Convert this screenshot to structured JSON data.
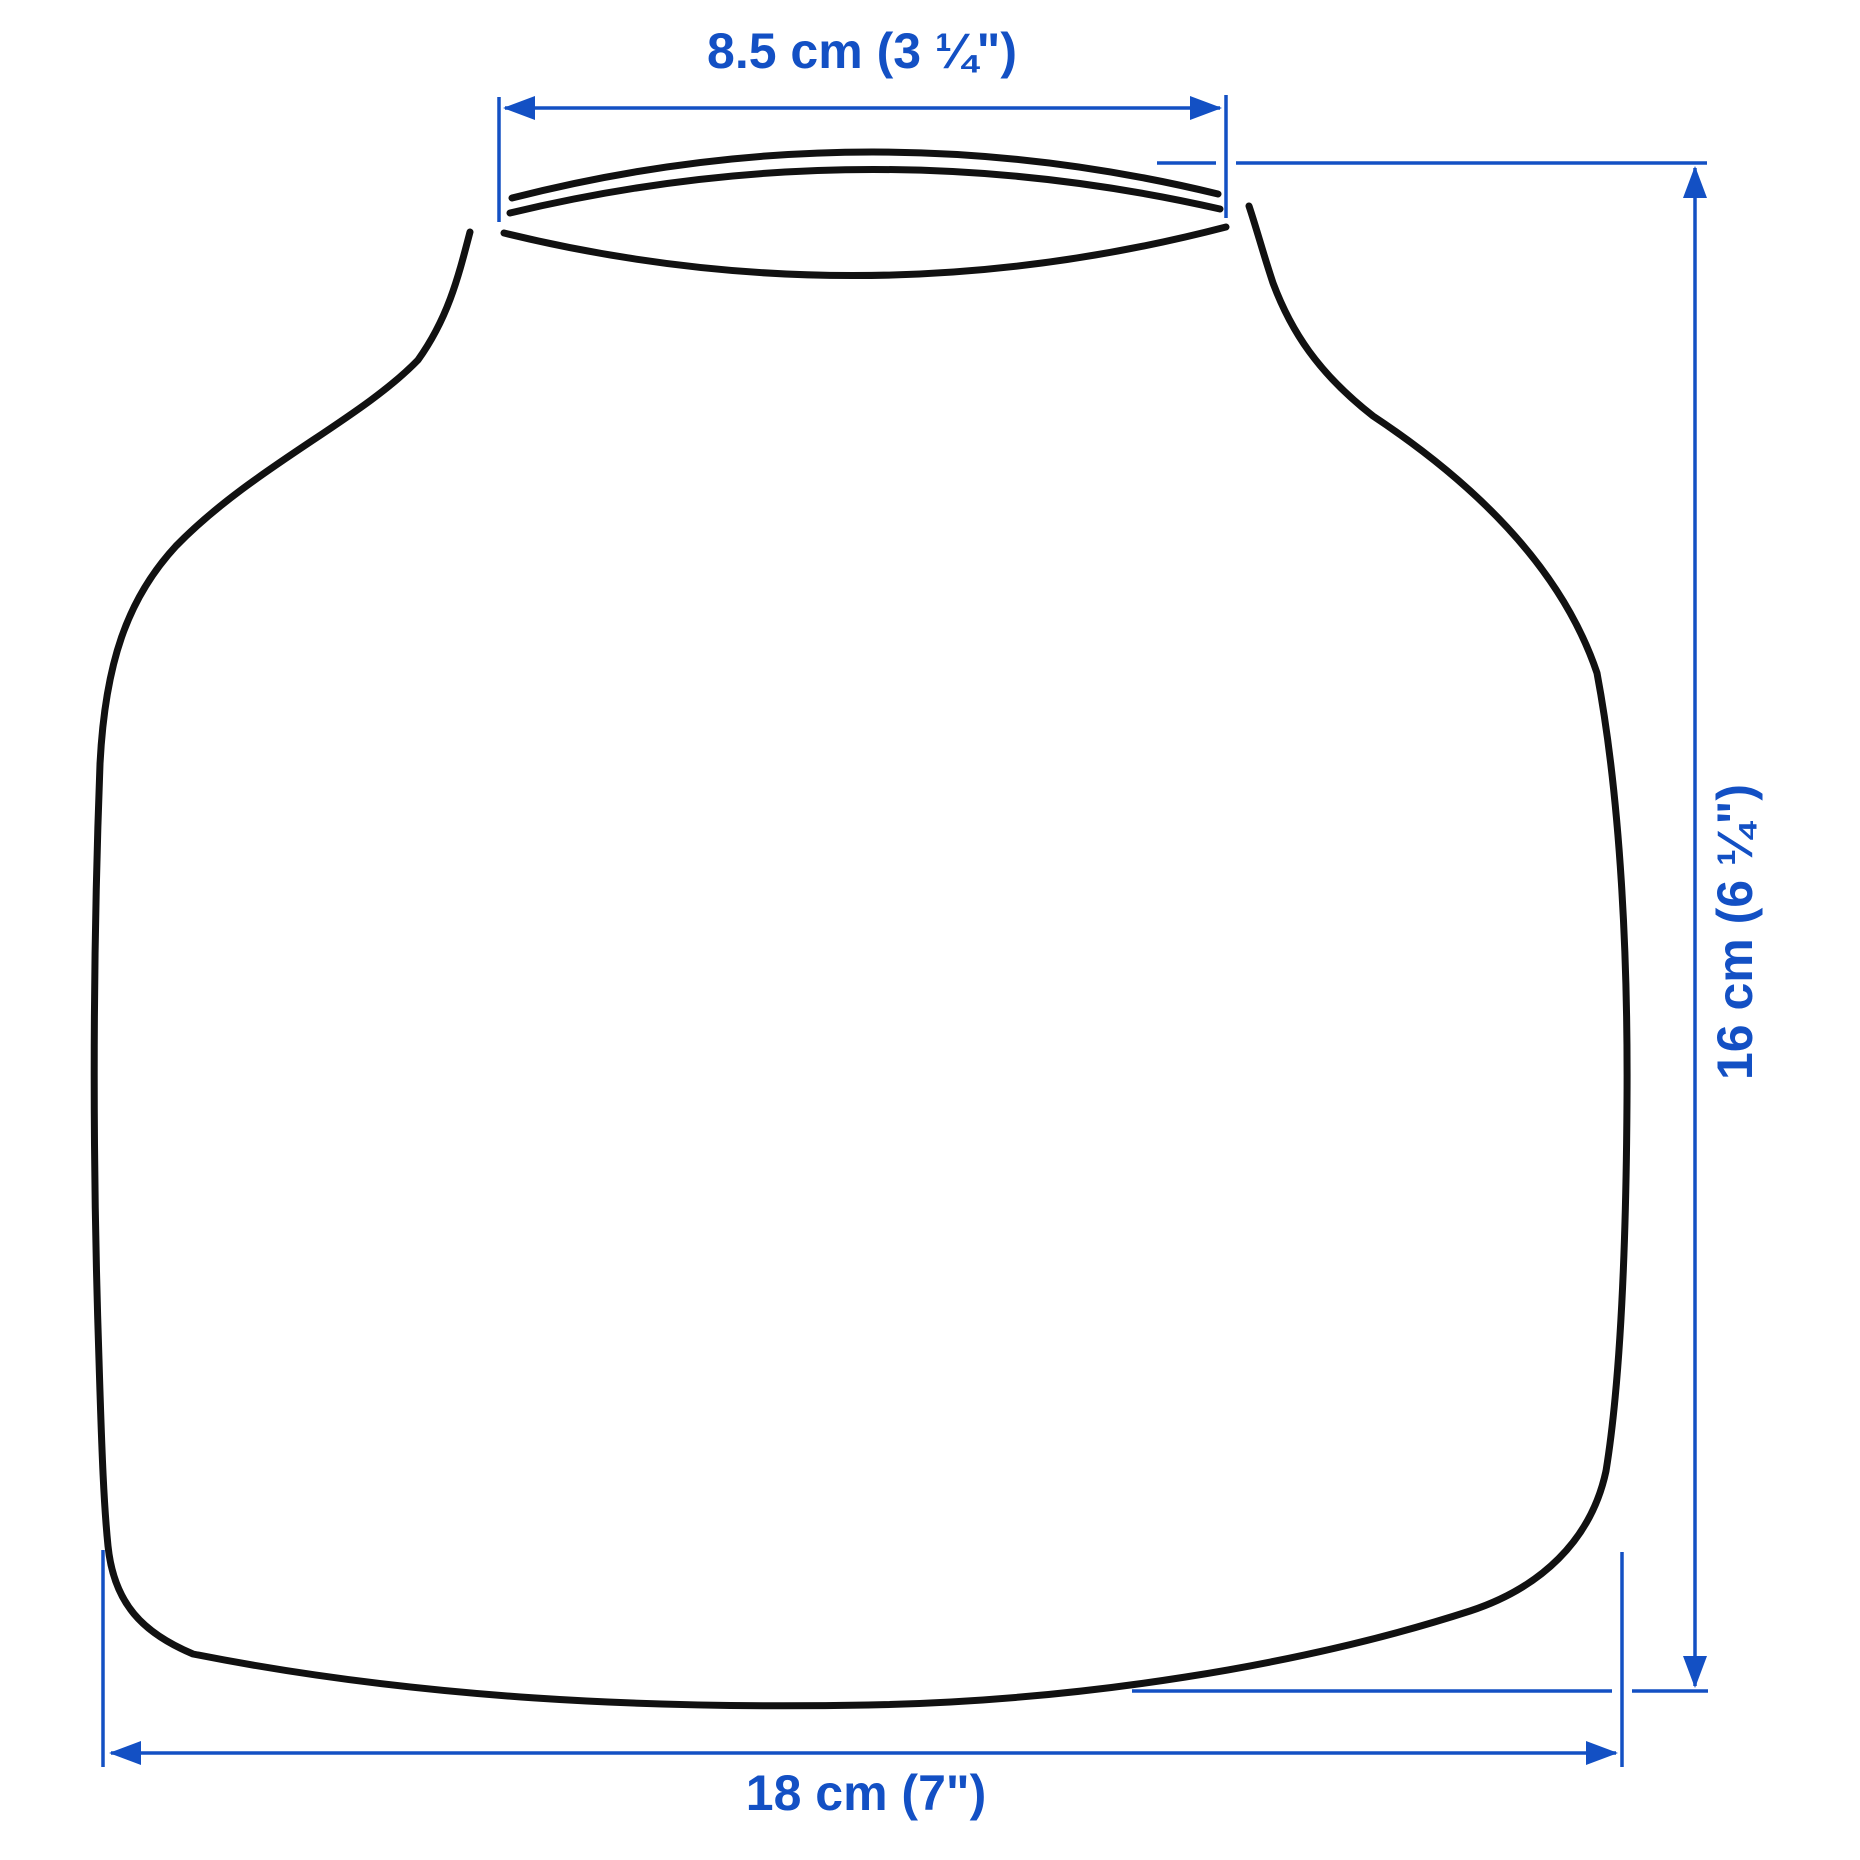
{
  "colors": {
    "accent": "#1350c4",
    "outline": "#111111",
    "background": "#ffffff"
  },
  "diagram": {
    "dimensions": {
      "opening_width": {
        "label": "8.5 cm (3 ¼\")",
        "metric": "8.5 cm",
        "imperial": "3 ¼\""
      },
      "height": {
        "label": "16 cm (6 ¼\")",
        "metric": "16 cm",
        "imperial": "6 ¼\""
      },
      "base_width": {
        "label": "18 cm (7\")",
        "metric": "18 cm",
        "imperial": "7\""
      }
    }
  }
}
